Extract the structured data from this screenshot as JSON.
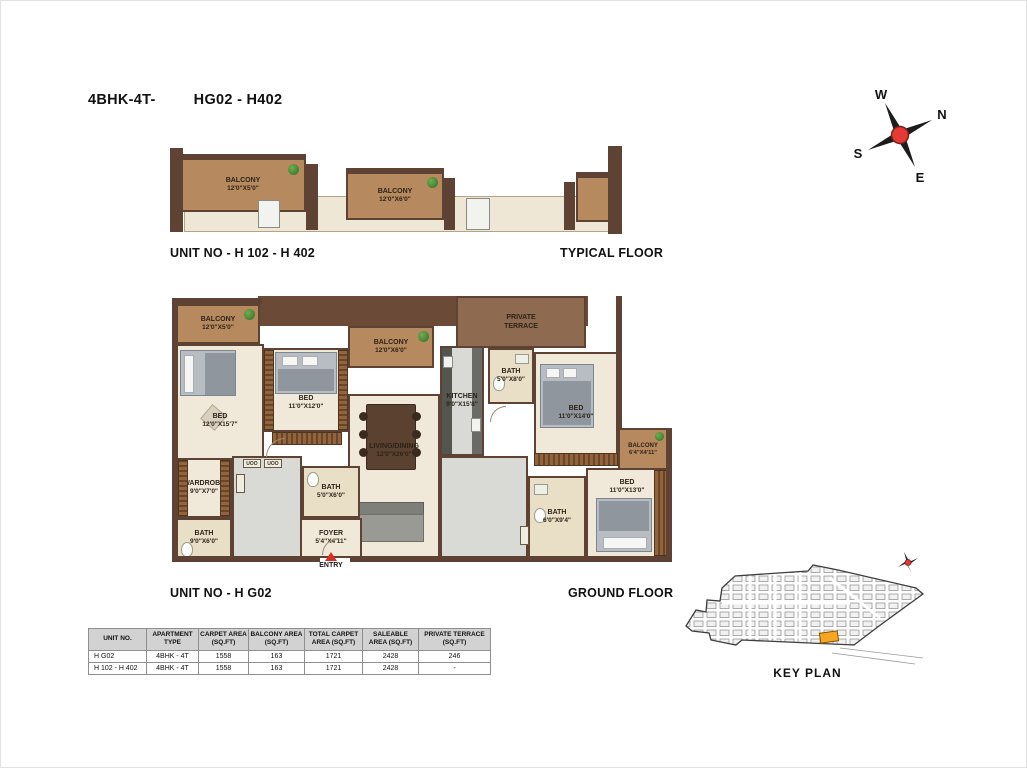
{
  "header": {
    "title_left": "4BHK-4T-",
    "title_right": "HG02 - H402"
  },
  "compass": {
    "w": "W",
    "n": "N",
    "s": "S",
    "e": "E"
  },
  "typical_floor": {
    "unit_label": "UNIT NO - H 102 - H 402",
    "floor_label": "TYPICAL FLOOR",
    "balcony1": {
      "name": "BALCONY",
      "dims": "12'0\"X5'0\""
    },
    "balcony2": {
      "name": "BALCONY",
      "dims": "12'0\"X6'0\""
    }
  },
  "ground_floor": {
    "unit_label": "UNIT NO - H G02",
    "floor_label": "GROUND FLOOR",
    "entry_label": "ENTRY",
    "cabinet_label": "UOO",
    "rooms": {
      "balcony1": {
        "name": "BALCONY",
        "dims": "12'0\"X5'0\""
      },
      "bed1": {
        "name": "BED",
        "dims": "12'0\"X15'7\""
      },
      "bed2": {
        "name": "BED",
        "dims": "11'0\"X12'0\""
      },
      "balcony2": {
        "name": "BALCONY",
        "dims": "12'0\"X6'0\""
      },
      "private_terrace": {
        "name": "PRIVATE TERRACE"
      },
      "kitchen": {
        "name": "KITCHEN",
        "dims": "9'0\"X15'8\""
      },
      "bath1": {
        "name": "BATH",
        "dims": "5'0\"X8'0\""
      },
      "bed3": {
        "name": "BED",
        "dims": "11'0\"X14'0\""
      },
      "balcony3": {
        "name": "BALCONY",
        "dims": "6'4\"X4'11\""
      },
      "living_dining": {
        "name": "LIVING/DINING",
        "dims": "12'0\"X26'0\""
      },
      "wardrobe": {
        "name": "WARDROBE",
        "dims": "9'0\"X7'0\""
      },
      "bath2": {
        "name": "BATH",
        "dims": "9'0\"X6'0\""
      },
      "bath3": {
        "name": "BATH",
        "dims": "5'0\"X6'0\""
      },
      "foyer": {
        "name": "FOYER",
        "dims": "5'4\"X4'11\""
      },
      "bed4": {
        "name": "BED",
        "dims": "11'0\"X13'0\""
      },
      "bath4": {
        "name": "BATH",
        "dims": "6'0\"X9'4\""
      }
    }
  },
  "key_plan": {
    "label": "KEY PLAN",
    "highlight_color": "#F5A623"
  },
  "area_table": {
    "headers": [
      "UNIT NO.",
      "APARTMENT TYPE",
      "CARPET AREA (SQ.FT)",
      "BALCONY AREA (SQ.FT)",
      "TOTAL CARPET AREA (SQ.FT)",
      "SALEABLE AREA (SQ.FT)",
      "PRIVATE TERRACE (SQ.FT)"
    ],
    "rows": [
      [
        "H G02",
        "4BHK - 4T",
        "1558",
        "163",
        "1721",
        "2428",
        "246"
      ],
      [
        "H 102 - H 402",
        "4BHK - 4T",
        "1558",
        "163",
        "1721",
        "2428",
        "-"
      ]
    ]
  },
  "colors": {
    "wall_brown": "#5E4334",
    "balcony_wood": "#B6895E",
    "terrace_brown": "#8E6A50",
    "room_floor": "#F0E9DA",
    "bath_floor": "#E9DFC6",
    "tile_gray": "#D9D9D5",
    "accent_red": "#D93025",
    "highlight_orange": "#F5A623"
  }
}
